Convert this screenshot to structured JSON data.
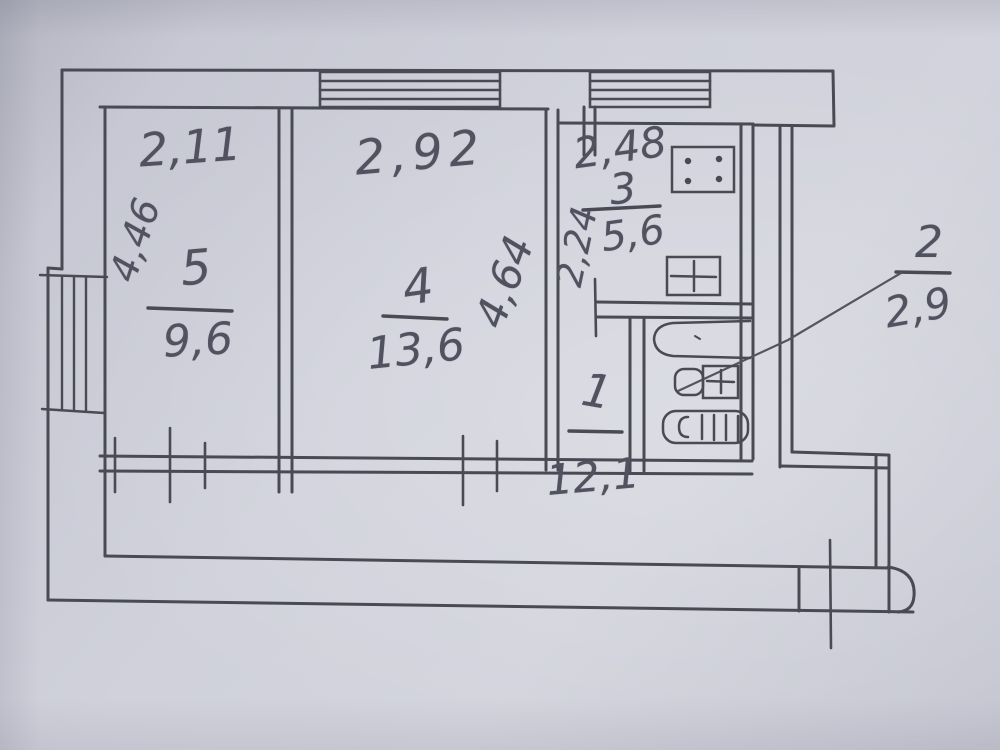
{
  "floorplan": {
    "rooms": {
      "room5": {
        "number": "5",
        "area": "9,6",
        "width": "2,11",
        "depth": "4,46"
      },
      "room4": {
        "number": "4",
        "area": "13,6",
        "width": "2,92",
        "depth": "4,64"
      },
      "room3": {
        "number": "3",
        "area": "5,6",
        "width": "2,48",
        "depth": "2,24"
      },
      "room1": {
        "number": "1",
        "area": "12,1"
      },
      "room2": {
        "number": "2",
        "area": "2,9"
      }
    },
    "fixtures": [
      "gas-stove-icon",
      "kitchen-sink-icon",
      "bathtub-icon",
      "toilet-icon",
      "washbasin-icon"
    ],
    "colors": {
      "paper": "#d0d1db",
      "ink": "#4a4a54",
      "pencil_text": "#51515f"
    }
  }
}
